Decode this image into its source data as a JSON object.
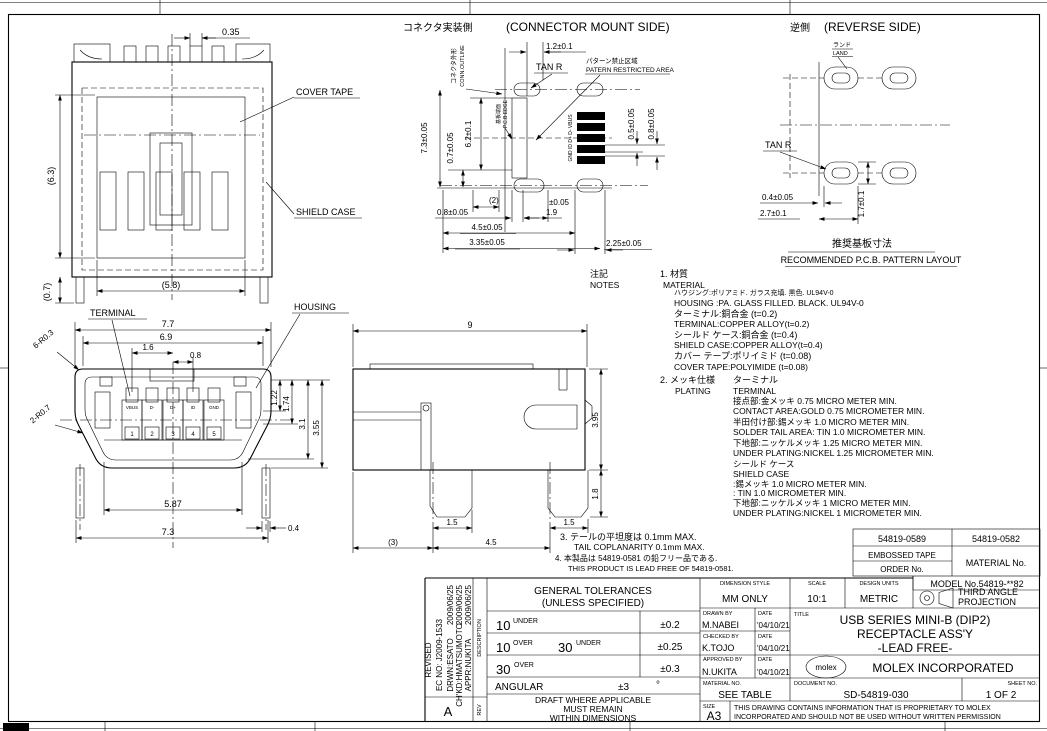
{
  "views": {
    "top": {
      "dim_035": "0.35",
      "dim_63": "(6.3)",
      "dim_07": "(0.7)",
      "dim_58": "(5.8)",
      "label_cover_tape": "COVER TAPE",
      "label_shield_case": "SHIELD CASE"
    },
    "front": {
      "label_terminal": "TERMINAL",
      "label_housing": "HOUSING",
      "dim_77": "7.7",
      "dim_69": "6.9",
      "dim_16": "1.6",
      "dim_08": "0.8",
      "dim_r03": "6-R0.3",
      "dim_r07": "2-R0.7",
      "dim_122": "1.22",
      "dim_174": "1.74",
      "dim_31": "3.1",
      "dim_355": "3.55",
      "dim_587": "5.87",
      "dim_73": "7.3",
      "dim_04": "0.4",
      "pins": [
        {
          "label": "VBUS",
          "no": "1"
        },
        {
          "label": "D-",
          "no": "2"
        },
        {
          "label": "D+",
          "no": "3"
        },
        {
          "label": "ID",
          "no": "4"
        },
        {
          "label": "GND",
          "no": "5"
        }
      ]
    },
    "side": {
      "dim_9": "9",
      "dim_395": "3.95",
      "dim_18": "1.8",
      "dim_15l": "1.5",
      "dim_15r": "1.5",
      "dim_45": "4.5",
      "dim_3": "(3)"
    },
    "mount": {
      "title_jp": "コネクタ実装側",
      "title_en": "(CONNECTOR MOUNT SIDE)",
      "outline_jp": "コネクタ外形",
      "outline_en": "CONN.OUTLINE",
      "tan_r": "TAN R",
      "restricted_jp": "パターン禁止区域",
      "restricted_en": "PATERN RESTRICTED AREA",
      "pcb_edge_jp": "基板端面",
      "pcb_edge_en": "P.C.B EDGE",
      "pad_labels": "GND ID D+ D- VBUS",
      "dim_12": "1.2±0.1",
      "dim_73": "7.3±0.05",
      "dim_07": "0.7±0.05",
      "dim_62": "6.2±0.1",
      "dim_05": "0.5±0.05",
      "dim_08r": "0.8±0.05",
      "dim_2": "(2)",
      "dim_08b": "0.8±0.05",
      "dim_005": "±0.05",
      "dim_19": "1.9",
      "dim_45": "4.5±0.05",
      "dim_335": "3.35±0.05",
      "dim_225": "2.25±0.05"
    },
    "reverse": {
      "title_jp": "逆側",
      "title_en": "(REVERSE SIDE)",
      "land_jp": "ランド",
      "land_en": "LAND",
      "tan_r": "TAN R",
      "dim_04": "0.4±0.05",
      "dim_27": "2.7±0.1",
      "dim_17": "1.7±0.1",
      "caption_jp": "推奨基板寸法",
      "caption_en": "RECOMMENDED P.C.B. PATTERN LAYOUT"
    }
  },
  "notes": {
    "label_jp": "注記",
    "label_en": "NOTES",
    "n1_jp": "1. 材質",
    "n1_en": "MATERIAL",
    "n1_lines": [
      "ハウジング:ポリアミド. ガラス充填. 黒色. UL94V-0",
      "HOUSING :PA. GLASS FILLED. BLACK. UL94V-0",
      "ターミナル:銅合金 (t=0.2)",
      "TERMINAL:COPPER ALLOY(t=0.2)",
      "シールド ケース:銅合金 (t=0.4)",
      "SHIELD CASE:COPPER ALLOY(t=0.4)",
      "カバー テープ:ポリイミド (t=0.08)",
      "COVER TAPE:POLYIMIDE (t=0.08)"
    ],
    "n2_jp": "2. メッキ仕様",
    "n2_en": "PLATING",
    "n2_sub_jp": "ターミナル",
    "n2_sub_en": "TERMINAL",
    "n2_lines": [
      "接点部:金メッキ 0.75 MICRO METER MIN.",
      "CONTACT AREA:GOLD 0.75 MICROMETER MIN.",
      "半田付け部:錫メッキ 1.0 MICRO METER MIN.",
      "SOLDER TAIL AREA: TIN 1.0 MICROMETER MIN.",
      "下地部:ニッケルメッキ 1.25 MICRO METER MIN.",
      "UNDER PLATING:NICKEL 1.25 MICROMETER MIN."
    ],
    "n2_shield_lines": [
      "シールド ケース",
      "SHIELD CASE",
      ":錫メッキ 1.0 MICRO METER MIN.",
      ": TIN 1.0 MICROMETER MIN.",
      "下地部:ニッケルメッキ 1 MICRO METER MIN.",
      "UNDER PLATING:NICKEL 1 MICROMETER MIN."
    ],
    "n3_jp": "3. テールの平坦度は 0.1mm MAX.",
    "n3_en": "TAIL COPLANARITY 0.1mm MAX.",
    "n4_jp": "4. 本製品は 54819-0581 の鉛フリー品である.",
    "n4_en": "THIS PRODUCT IS LEAD FREE OF 54819-0581."
  },
  "order_table": {
    "tape_no": "54819-0589",
    "material_no_value": "54819-0582",
    "row2_left1": "EMBOSSED TAPE",
    "row2_left2": "ORDER No.",
    "row2_right": "MATERIAL No.",
    "model": "MODEL No.54819-**82"
  },
  "tolerances": {
    "header1": "GENERAL TOLERANCES",
    "header2": "(UNLESS SPECIFIED)",
    "r1_v1": "10",
    "r1_s1": "UNDER",
    "r1_tol": "±0.2",
    "r2_v1": "10",
    "r2_s1": "OVER",
    "r2_v2": "30",
    "r2_s2": "UNDER",
    "r2_tol": "±0.25",
    "r3_v1": "30",
    "r3_s1": "OVER",
    "r3_tol": "±0.3",
    "ang_label": "ANGULAR",
    "ang_tol": "±3",
    "ang_deg": "°",
    "footer1": "DRAFT WHERE APPLICABLE",
    "footer2": "MUST REMAIN",
    "footer3": "WITHIN DIMENSIONS"
  },
  "title_block": {
    "dimension_style_label": "DIMENSION STYLE",
    "dimension_style": "MM ONLY",
    "scale_label": "SCALE",
    "scale": "10:1",
    "design_units_label": "DESIGN UNITS",
    "design_units": "METRIC",
    "projection_line1": "THIRD ANGLE",
    "projection_line2": "PROJECTION",
    "drawn_label": "DRAWN BY",
    "drawn": "M.NABEI",
    "date_label1": "DATE",
    "drawn_date": "'04/10/21",
    "checked_label": "CHECKED BY",
    "checked": "K.TOJO",
    "date_label2": "DATE",
    "checked_date": "'04/10/21",
    "approved_label": "APPROVED BY",
    "approved": "N.UKITA",
    "date_label3": "DATE",
    "approved_date": "'04/10/21",
    "title_label": "TITLE",
    "title_line1": "USB SERIES MINI-B (DIP2)",
    "title_line2": "RECEPTACLE ASS'Y",
    "title_line3": "-LEAD FREE-",
    "logo": "molex",
    "company": "MOLEX INCORPORATED",
    "material_label": "MATERIAL NO.",
    "material": "SEE TABLE",
    "document_label": "DOCUMENT NO.",
    "document": "SD-54819-030",
    "sheet_label": "SHEET NO.",
    "sheet": "1 OF 2",
    "size_label": "SIZE",
    "size": "A3",
    "proprietary_line1": "THIS DRAWING CONTAINS INFORMATION THAT IS PROPRIETARY TO MOLEX",
    "proprietary_line2": "INCORPORATED AND SHOULD NOT BE USED WITHOUT WRITTEN PERMISSION"
  },
  "revision": {
    "status": "REVISED",
    "ec_no": "EC NO: J2009-1533",
    "drwn": "DRWN:ESATO",
    "chkd": "CH'KD:HMATSUMOTO",
    "appr": "APPR:NUKITA",
    "date1": "2009/06/25",
    "date2": "2009/06/25",
    "date3": "2009/06/25",
    "rev_letter": "A",
    "col_description": "DESCRIPTION",
    "col_rev": "REV"
  }
}
